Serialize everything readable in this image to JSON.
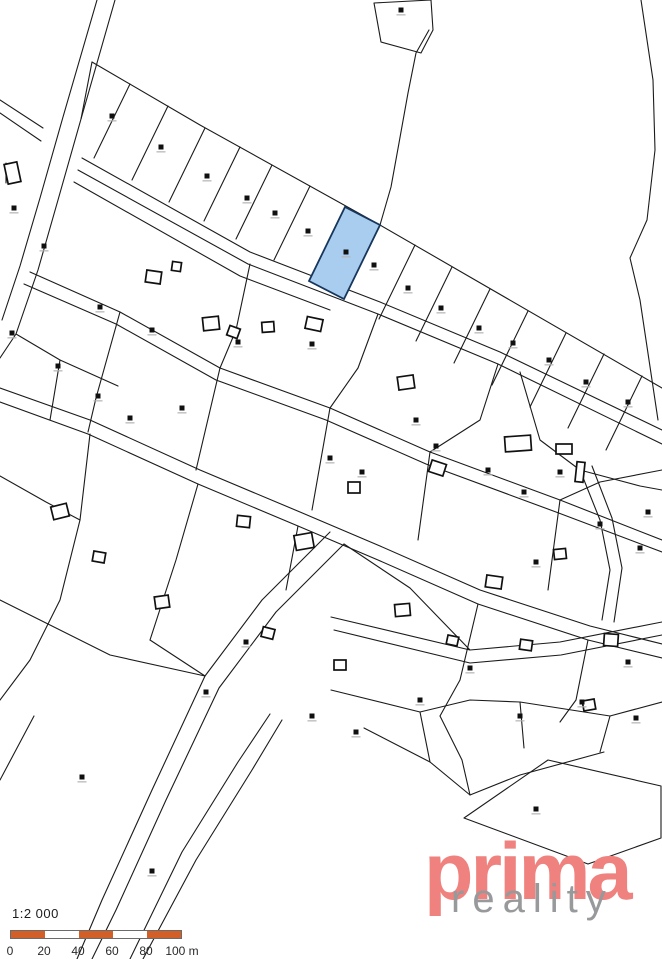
{
  "scalebar": {
    "ratio": "1:2 000",
    "labels": [
      "0",
      "20",
      "40",
      "60",
      "80",
      "100 m"
    ],
    "label_positions": [
      10,
      44,
      78,
      112,
      146,
      182
    ],
    "bar_color": "#d25f28",
    "alt_color": "#ffffff",
    "segments": 5,
    "segment_width": 34
  },
  "logo": {
    "primary": "prima",
    "secondary": "reality",
    "primary_color": "#ef827e",
    "secondary_color": "#97999b"
  },
  "map": {
    "background": "#ffffff",
    "line_color": "#1b1b1b",
    "marker_color": "#101010",
    "marker_label_color": "#b3b3b3",
    "highlight": {
      "fill": "#a9cdee",
      "stroke": "#17365d",
      "points": "345,207 380,225 344,299 309,281"
    },
    "paths": [
      "M97,0 L63,117 L40,198 L20,266 L2,320",
      "M115,0 L81,119 L58,200 L38,270 L16,334 L0,358",
      "M0,100 L43,128",
      "M0,113 L41,141",
      "M81,119 L92,62",
      "M92,62 L200,125 L380,225 L662,388",
      "M82,158 L250,252 L380,302 L500,352 L662,430",
      "M78,170 L248,264 L378,314 L498,364 L662,444",
      "M74,182 L240,276 L330,310",
      "M374,3 L431,0 L433,30 L421,53 L381,42 Z",
      "M429,30 L416,53 L408,93 L399,143 L391,187 L380,225",
      "M641,0 L653,80 L655,150 L647,220 L630,258 L640,300 L652,380 L658,420",
      "M130,84 L94,158",
      "M168,106 L132,180",
      "M205,128 L169,202",
      "M240,147 L204,221",
      "M272,165 L236,239",
      "M310,186 L274,260",
      "M415,245 L379,319",
      "M452,267 L416,341",
      "M490,289 L454,363",
      "M528,311 L492,385",
      "M566,333 L530,407",
      "M604,354 L568,428",
      "M642,376 L606,450",
      "M30,272 L120,312 L220,368 L330,408 L430,452 L560,500 L662,540",
      "M24,284 L116,324 L216,380 L326,420 L426,464 L556,512 L662,552",
      "M0,388 L90,420 L200,470 L300,512 L380,546 L480,590 L590,626 L662,644",
      "M0,402 L88,434 L198,484 L298,526 L378,560 L478,604 L588,640 L662,658",
      "M330,532 L262,600 L205,676 L152,790 L102,900 L77,959",
      "M344,544 L276,612 L219,688 L166,800 L116,910 L92,959",
      "M331,617 L470,650 L560,642 L662,622",
      "M334,630 L470,663 L561,655 L662,635",
      "M282,720 L252,770 L196,860 L143,959",
      "M270,714 L238,762 L182,852 L130,959",
      "M34,716 L0,780",
      "M364,728 L430,762 L470,795",
      "M604,752 L520,775 L470,795",
      "M440,716 L462,760 L470,795",
      "M464,818 L548,760 L661,786 L661,838 L588,864 Z",
      "M331,690 L420,712 L470,700 L520,702 L610,716 L662,702",
      "M420,712 L430,762",
      "M520,702 L524,748",
      "M610,716 L600,752",
      "M520,372 L540,440 L580,470 L640,486 L662,490",
      "M580,470 L600,520 L610,570 L602,620",
      "M592,466 L612,518 L622,568 L614,622",
      "M120,312 L96,398 L88,432",
      "M220,368 L196,470",
      "M330,408 L312,510",
      "M430,452 L418,540",
      "M560,500 L548,590",
      "M90,434 L80,520 L60,600 L30,660 L0,700",
      "M198,484 L176,560 L150,640",
      "M298,526 L286,590",
      "M478,604 L460,680 L440,716",
      "M588,640 L576,700 L560,722",
      "M16,334 L60,360 L118,386",
      "M60,360 L50,420",
      "M250,264 L236,330 L220,368",
      "M378,314 L358,368 L330,408",
      "M498,364 L480,420 L430,452",
      "M662,470 L600,482 L560,500",
      "M0,600 L110,655 L205,676",
      "M344,544 L410,588 L470,650",
      "M0,476 L46,502 L80,520",
      "M150,640 L205,676",
      "M6,163 L6,183"
    ],
    "buildings": [
      [
        6,
        163,
        13,
        20,
        -12
      ],
      [
        146,
        271,
        15,
        12,
        8
      ],
      [
        172,
        262,
        9,
        9,
        8
      ],
      [
        203,
        317,
        16,
        13,
        -6
      ],
      [
        228,
        327,
        11,
        10,
        20
      ],
      [
        262,
        322,
        12,
        10,
        -4
      ],
      [
        306,
        318,
        16,
        12,
        12
      ],
      [
        398,
        376,
        16,
        13,
        -8
      ],
      [
        430,
        462,
        15,
        12,
        18
      ],
      [
        348,
        482,
        12,
        11,
        0
      ],
      [
        295,
        534,
        18,
        15,
        -10
      ],
      [
        237,
        516,
        13,
        11,
        6
      ],
      [
        486,
        576,
        16,
        12,
        8
      ],
      [
        554,
        549,
        12,
        10,
        -6
      ],
      [
        604,
        634,
        14,
        12,
        4
      ],
      [
        52,
        505,
        16,
        13,
        -14
      ],
      [
        93,
        552,
        12,
        10,
        10
      ],
      [
        155,
        596,
        14,
        12,
        -8
      ],
      [
        262,
        628,
        12,
        10,
        14
      ],
      [
        395,
        604,
        15,
        12,
        -5
      ],
      [
        520,
        640,
        12,
        10,
        8
      ],
      [
        583,
        700,
        12,
        10,
        -10
      ],
      [
        334,
        660,
        12,
        10,
        0
      ],
      [
        447,
        636,
        11,
        9,
        12
      ],
      [
        505,
        436,
        26,
        15,
        -4
      ],
      [
        556,
        444,
        16,
        10,
        0
      ],
      [
        576,
        462,
        8,
        20,
        6
      ]
    ],
    "markers": [
      [
        112,
        116
      ],
      [
        161,
        147
      ],
      [
        207,
        176
      ],
      [
        247,
        198
      ],
      [
        275,
        213
      ],
      [
        308,
        231
      ],
      [
        374,
        265
      ],
      [
        408,
        288
      ],
      [
        441,
        308
      ],
      [
        479,
        328
      ],
      [
        513,
        343
      ],
      [
        549,
        360
      ],
      [
        586,
        382
      ],
      [
        628,
        402
      ],
      [
        346,
        252
      ],
      [
        401,
        10
      ],
      [
        14,
        208
      ],
      [
        44,
        246
      ],
      [
        12,
        333
      ],
      [
        100,
        307
      ],
      [
        152,
        330
      ],
      [
        238,
        342
      ],
      [
        312,
        344
      ],
      [
        58,
        366
      ],
      [
        98,
        396
      ],
      [
        130,
        418
      ],
      [
        182,
        408
      ],
      [
        330,
        458
      ],
      [
        362,
        472
      ],
      [
        416,
        420
      ],
      [
        436,
        446
      ],
      [
        488,
        470
      ],
      [
        524,
        492
      ],
      [
        560,
        472
      ],
      [
        600,
        524
      ],
      [
        640,
        548
      ],
      [
        648,
        512
      ],
      [
        536,
        562
      ],
      [
        246,
        642
      ],
      [
        206,
        692
      ],
      [
        312,
        716
      ],
      [
        356,
        732
      ],
      [
        420,
        700
      ],
      [
        470,
        668
      ],
      [
        582,
        702
      ],
      [
        628,
        662
      ],
      [
        520,
        716
      ],
      [
        636,
        718
      ],
      [
        82,
        777
      ],
      [
        152,
        871
      ],
      [
        536,
        809
      ]
    ]
  }
}
